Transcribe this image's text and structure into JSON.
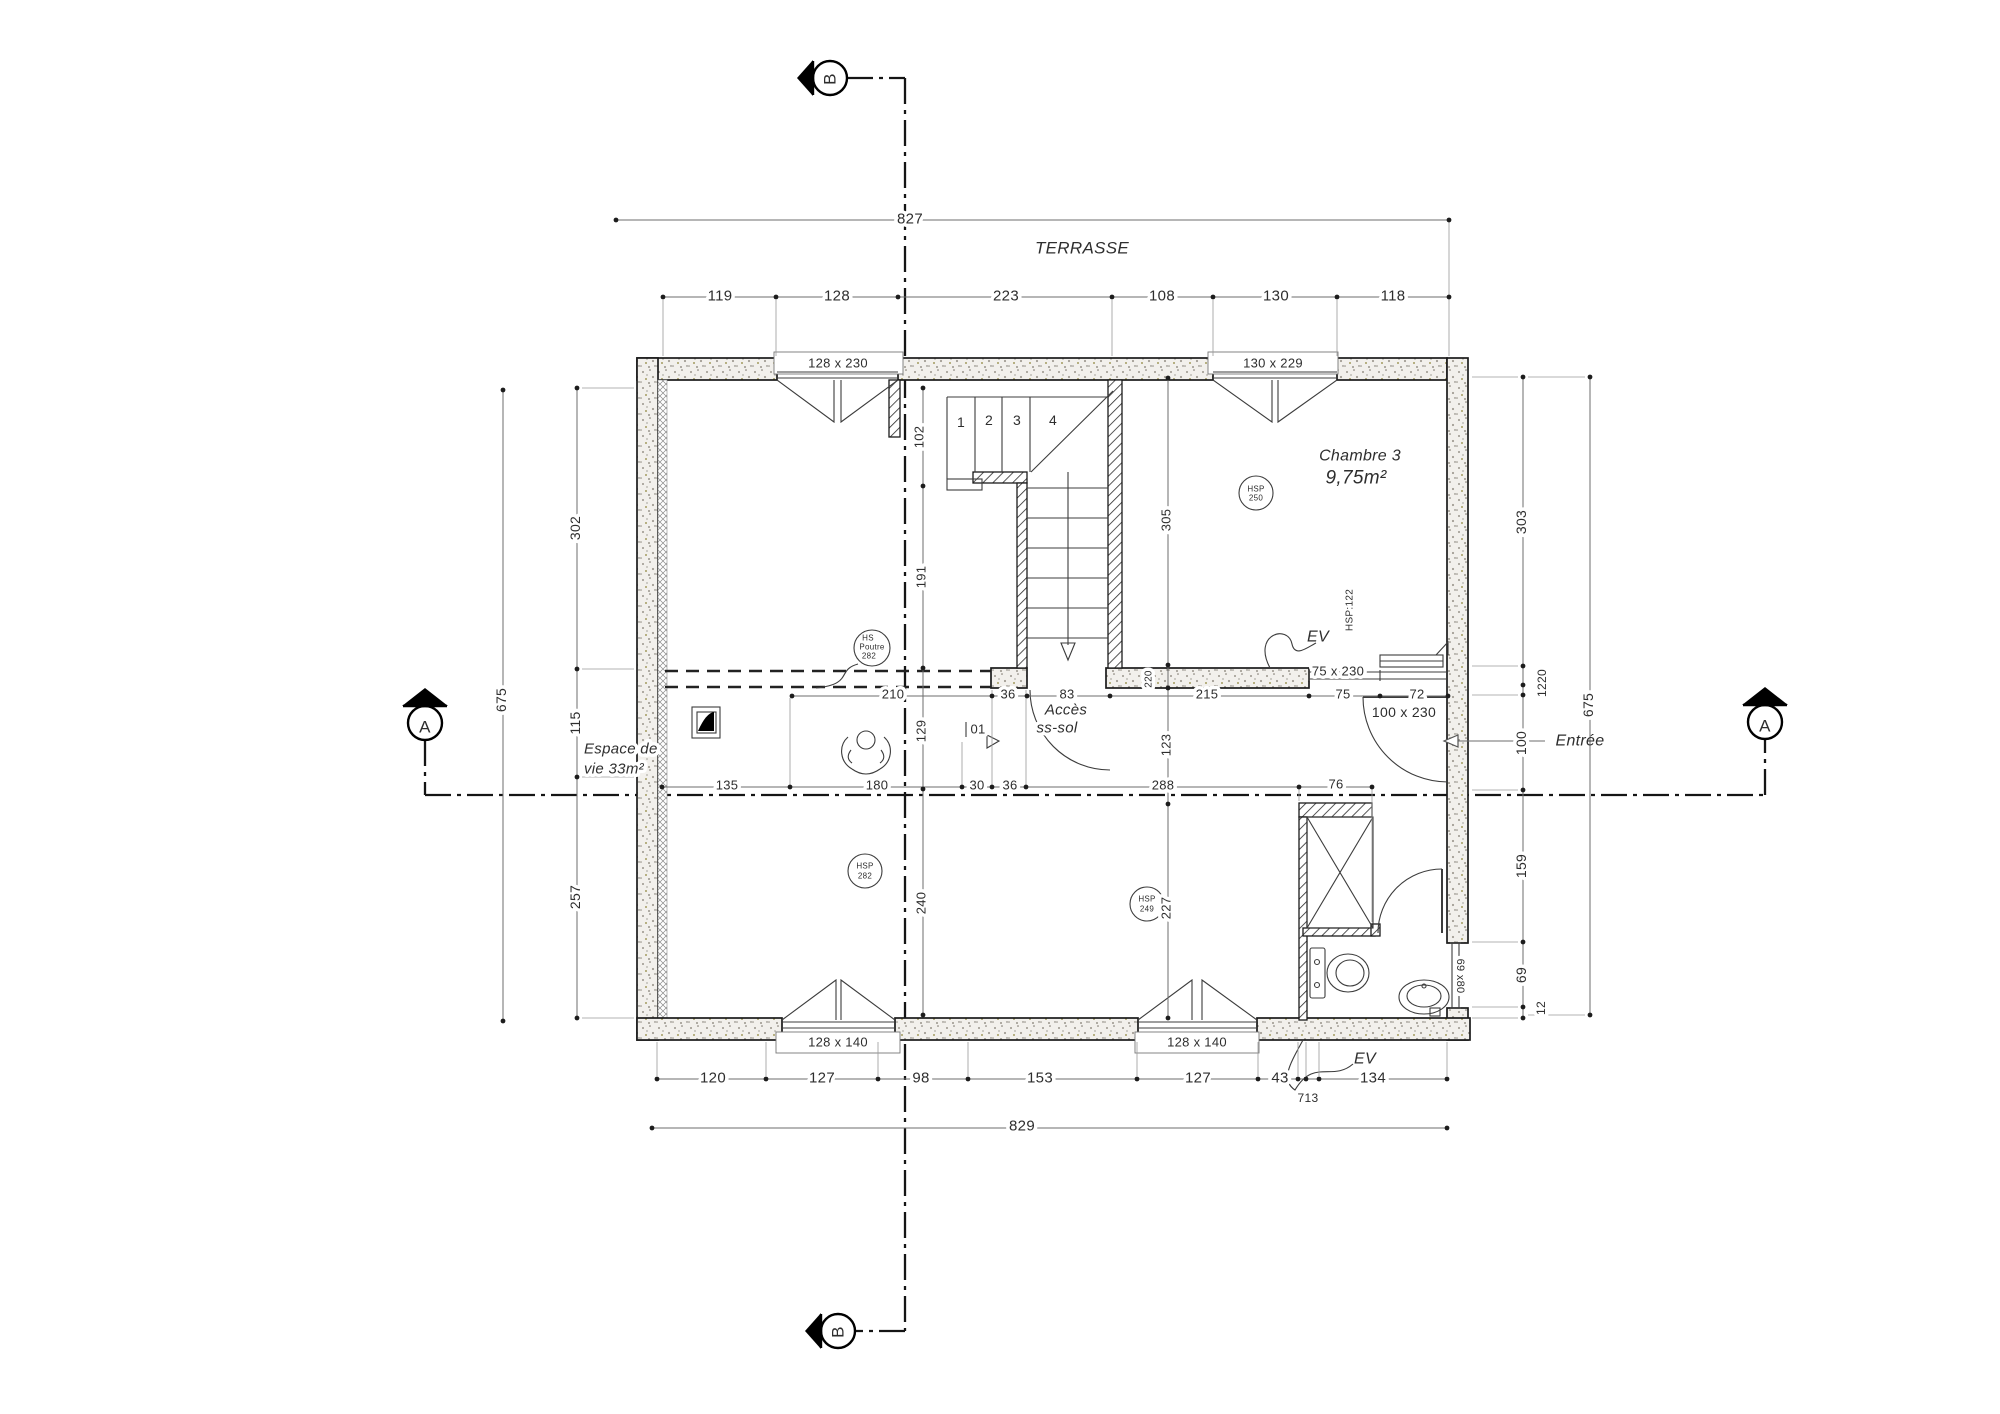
{
  "drawing": {
    "type": "architectural-floor-plan",
    "level_texts": [
      "TERRASSE",
      "Accès ss-sol",
      "Entrée"
    ],
    "rooms": [
      {
        "name": "Chambre 3",
        "area": "9,75m²",
        "ceiling_tag": "HSP 250"
      },
      {
        "name": "Espace de vie 33m²",
        "ceiling_tags": [
          "HS Poutre 282",
          "HSP 282",
          "HSP 249"
        ]
      }
    ],
    "section_markers": [
      "A",
      "A",
      "B",
      "B"
    ],
    "openings": [
      "128 x 230",
      "130 x 229",
      "75 x 230",
      "100 x 230",
      "128 x 140",
      "128 x 140",
      "69 x80"
    ],
    "dimension_strings": {
      "terrace_total": 827,
      "terrace_segments": [
        119,
        128,
        223,
        108,
        130,
        118
      ],
      "bottom_total": 829,
      "bottom_segments": [
        120,
        127,
        98,
        153,
        127,
        43,
        7,
        13,
        134
      ],
      "left_vertical": [
        302,
        115,
        257
      ],
      "left_total": 675,
      "right_vertical": [
        303,
        1220,
        100,
        159,
        69,
        12
      ],
      "right_total": 675,
      "interior_horizontal_upper": [
        210,
        36,
        83,
        215,
        75,
        72
      ],
      "interior_horizontal_lower": [
        135,
        180,
        30,
        36,
        288,
        76
      ],
      "interior_vertical_center": [
        102,
        191,
        129,
        240
      ],
      "interior_vertical_right": [
        305,
        123,
        227
      ],
      "wall_thickness": 220
    }
  },
  "labels": [
    {
      "name": "section-b-top-letter",
      "text": "B",
      "x": 830,
      "y": 79,
      "rot": -90,
      "size": 17
    },
    {
      "name": "dim-terrasse-total",
      "text": "827",
      "x": 910,
      "y": 219,
      "size": 15,
      "halo": true
    },
    {
      "name": "terrasse-title",
      "text": "TERRASSE",
      "x": 1082,
      "y": 248,
      "size": 17,
      "style": "italic"
    },
    {
      "name": "dim-terrasse-119",
      "text": "119",
      "x": 720,
      "y": 296,
      "size": 15,
      "halo": true
    },
    {
      "name": "dim-terrasse-128",
      "text": "128",
      "x": 837,
      "y": 296,
      "size": 15,
      "halo": true
    },
    {
      "name": "dim-terrasse-223",
      "text": "223",
      "x": 1006,
      "y": 296,
      "size": 15,
      "halo": true
    },
    {
      "name": "dim-terrasse-108",
      "text": "108",
      "x": 1162,
      "y": 296,
      "size": 15,
      "halo": true
    },
    {
      "name": "dim-terrasse-130",
      "text": "130",
      "x": 1276,
      "y": 296,
      "size": 15,
      "halo": true
    },
    {
      "name": "dim-terrasse-118",
      "text": "118",
      "x": 1393,
      "y": 296,
      "size": 15,
      "halo": true
    },
    {
      "name": "window-label-top-left",
      "text": "128 x 230",
      "x": 838,
      "y": 363,
      "size": 13
    },
    {
      "name": "window-label-top-right",
      "text": "130 x 229",
      "x": 1273,
      "y": 363,
      "size": 13
    },
    {
      "name": "stair-step-1",
      "text": "1",
      "x": 961,
      "y": 422,
      "size": 14
    },
    {
      "name": "stair-step-2",
      "text": "2",
      "x": 989,
      "y": 420,
      "size": 14
    },
    {
      "name": "stair-step-3",
      "text": "3",
      "x": 1017,
      "y": 420,
      "size": 14
    },
    {
      "name": "stair-step-4",
      "text": "4",
      "x": 1053,
      "y": 420,
      "size": 14
    },
    {
      "name": "dim-102",
      "text": "102",
      "x": 919,
      "y": 437,
      "rot": -90,
      "size": 13,
      "halo": true
    },
    {
      "name": "dim-191",
      "text": "191",
      "x": 921,
      "y": 577,
      "rot": -90,
      "size": 13,
      "halo": true
    },
    {
      "name": "dim-129",
      "text": "129",
      "x": 921,
      "y": 731,
      "rot": -90,
      "size": 13,
      "halo": true
    },
    {
      "name": "dim-240",
      "text": "240",
      "x": 921,
      "y": 903,
      "rot": -90,
      "size": 13,
      "halo": true
    },
    {
      "name": "dim-305",
      "text": "305",
      "x": 1166,
      "y": 520,
      "rot": -90,
      "size": 13,
      "halo": true
    },
    {
      "name": "dim-123",
      "text": "123",
      "x": 1166,
      "y": 745,
      "rot": -90,
      "size": 13,
      "halo": true
    },
    {
      "name": "dim-227",
      "text": "227",
      "x": 1166,
      "y": 908,
      "rot": -90,
      "size": 13,
      "halo": true
    },
    {
      "name": "dim-220",
      "text": "220",
      "x": 1149,
      "y": 679,
      "rot": -90,
      "size": 10,
      "halo": true
    },
    {
      "name": "room-chambre3-name",
      "text": "Chambre 3",
      "x": 1360,
      "y": 456,
      "size": 16,
      "style": "italic"
    },
    {
      "name": "room-chambre3-area",
      "text": "9,75m²",
      "x": 1356,
      "y": 478,
      "size": 19,
      "style": "italic"
    },
    {
      "name": "hsp250-line1",
      "text": "HSP",
      "x": 1256,
      "y": 489,
      "size": 8
    },
    {
      "name": "hsp250-line2",
      "text": "250",
      "x": 1256,
      "y": 498,
      "size": 8
    },
    {
      "name": "hsp122-note",
      "text": "HSP:122",
      "x": 1350,
      "y": 610,
      "rot": -90,
      "size": 10
    },
    {
      "name": "ev-chambre",
      "text": "EV",
      "x": 1318,
      "y": 637,
      "size": 16,
      "style": "italic"
    },
    {
      "name": "window-label-75x230",
      "text": "75 x 230",
      "x": 1338,
      "y": 671,
      "size": 13,
      "halo": true
    },
    {
      "name": "door-label-100x230",
      "text": "100 x 230",
      "x": 1404,
      "y": 712,
      "size": 14,
      "halo": true
    },
    {
      "name": "entree-label",
      "text": "Entrée",
      "x": 1580,
      "y": 741,
      "size": 16,
      "style": "italic"
    },
    {
      "name": "acces-line1",
      "text": "Accès",
      "x": 1066,
      "y": 710,
      "size": 15,
      "style": "italic",
      "halo": true
    },
    {
      "name": "acces-line2",
      "text": "ss-sol",
      "x": 1057,
      "y": 728,
      "size": 15,
      "style": "italic",
      "halo": true
    },
    {
      "name": "door-tag-01",
      "text": "01",
      "x": 978,
      "y": 729,
      "size": 13,
      "halo": true
    },
    {
      "name": "dim-210",
      "text": "210",
      "x": 893,
      "y": 694,
      "size": 13,
      "halo": true
    },
    {
      "name": "dim-36-upper",
      "text": "36",
      "x": 1008,
      "y": 694,
      "size": 13,
      "halo": true
    },
    {
      "name": "dim-83",
      "text": "83",
      "x": 1067,
      "y": 694,
      "size": 13,
      "halo": true
    },
    {
      "name": "dim-215",
      "text": "215",
      "x": 1207,
      "y": 694,
      "size": 13,
      "halo": true
    },
    {
      "name": "dim-75",
      "text": "75",
      "x": 1343,
      "y": 694,
      "size": 13,
      "halo": true
    },
    {
      "name": "dim-72",
      "text": "72",
      "x": 1417,
      "y": 694,
      "size": 13,
      "halo": true
    },
    {
      "name": "dim-135",
      "text": "135",
      "x": 727,
      "y": 785,
      "size": 13,
      "halo": true
    },
    {
      "name": "dim-180",
      "text": "180",
      "x": 877,
      "y": 785,
      "size": 13,
      "halo": true
    },
    {
      "name": "dim-30",
      "text": "30",
      "x": 977,
      "y": 785,
      "size": 13,
      "halo": true
    },
    {
      "name": "dim-36-lower",
      "text": "36",
      "x": 1010,
      "y": 785,
      "size": 13,
      "halo": true
    },
    {
      "name": "dim-288",
      "text": "288",
      "x": 1163,
      "y": 785,
      "size": 13,
      "halo": true
    },
    {
      "name": "dim-76",
      "text": "76",
      "x": 1336,
      "y": 784,
      "size": 13,
      "halo": true
    },
    {
      "name": "hs-poutre-line1",
      "text": "HS",
      "x": 868,
      "y": 638,
      "size": 8
    },
    {
      "name": "hs-poutre-line2",
      "text": "Poutre",
      "x": 872,
      "y": 647,
      "size": 8
    },
    {
      "name": "hs-poutre-line3",
      "text": "282",
      "x": 869,
      "y": 656,
      "size": 8
    },
    {
      "name": "hsp282-line1",
      "text": "HSP",
      "x": 865,
      "y": 866,
      "size": 8
    },
    {
      "name": "hsp282-line2",
      "text": "282",
      "x": 865,
      "y": 876,
      "size": 8
    },
    {
      "name": "hsp249-line1",
      "text": "HSP",
      "x": 1147,
      "y": 899,
      "size": 8
    },
    {
      "name": "hsp249-line2",
      "text": "249",
      "x": 1147,
      "y": 909,
      "size": 8
    },
    {
      "name": "espace-de-vie-line1",
      "text": "Espace de",
      "x": 584,
      "y": 749,
      "size": 15,
      "style": "italic",
      "anchor": "start",
      "halo": true
    },
    {
      "name": "espace-de-vie-line2",
      "text": "vie 33m²",
      "x": 584,
      "y": 769,
      "size": 15,
      "style": "italic",
      "anchor": "start",
      "halo": true
    },
    {
      "name": "dim-302",
      "text": "302",
      "x": 575,
      "y": 528,
      "rot": -90,
      "size": 14,
      "halo": true
    },
    {
      "name": "dim-115",
      "text": "115",
      "x": 575,
      "y": 723,
      "rot": -90,
      "size": 14,
      "halo": true
    },
    {
      "name": "dim-257",
      "text": "257",
      "x": 575,
      "y": 897,
      "rot": -90,
      "size": 14,
      "halo": true
    },
    {
      "name": "dim-675-left",
      "text": "675",
      "x": 501,
      "y": 700,
      "rot": -90,
      "size": 14,
      "halo": true
    },
    {
      "name": "dim-303",
      "text": "303",
      "x": 1521,
      "y": 522,
      "rot": -90,
      "size": 14,
      "halo": true
    },
    {
      "name": "dim-1220",
      "text": "1220",
      "x": 1542,
      "y": 683,
      "rot": -90,
      "size": 12,
      "halo": true
    },
    {
      "name": "dim-100",
      "text": "100",
      "x": 1521,
      "y": 743,
      "rot": -90,
      "size": 14,
      "halo": true
    },
    {
      "name": "dim-159",
      "text": "159",
      "x": 1521,
      "y": 866,
      "rot": -90,
      "size": 14,
      "halo": true
    },
    {
      "name": "dim-69",
      "text": "69",
      "x": 1521,
      "y": 975,
      "rot": -90,
      "size": 14,
      "halo": true
    },
    {
      "name": "dim-12",
      "text": "12",
      "x": 1541,
      "y": 1008,
      "rot": -90,
      "size": 12,
      "halo": true
    },
    {
      "name": "dim-675-right",
      "text": "675",
      "x": 1588,
      "y": 705,
      "rot": -90,
      "size": 14,
      "halo": true
    },
    {
      "name": "window-label-69x80",
      "text": "69 x80",
      "x": 1460,
      "y": 976,
      "rot": 90,
      "size": 11,
      "halo": true
    },
    {
      "name": "window-label-bottom-left",
      "text": "128 x 140",
      "x": 838,
      "y": 1042,
      "size": 13
    },
    {
      "name": "window-label-bottom-right",
      "text": "128 x 140",
      "x": 1197,
      "y": 1042,
      "size": 13
    },
    {
      "name": "ev-bottom",
      "text": "EV",
      "x": 1365,
      "y": 1059,
      "size": 16,
      "style": "italic"
    },
    {
      "name": "dim-120",
      "text": "120",
      "x": 713,
      "y": 1078,
      "size": 15,
      "halo": true
    },
    {
      "name": "dim-127-a",
      "text": "127",
      "x": 822,
      "y": 1078,
      "size": 15,
      "halo": true
    },
    {
      "name": "dim-98",
      "text": "98",
      "x": 921,
      "y": 1078,
      "size": 15,
      "halo": true
    },
    {
      "name": "dim-153",
      "text": "153",
      "x": 1040,
      "y": 1078,
      "size": 15,
      "halo": true
    },
    {
      "name": "dim-127-b",
      "text": "127",
      "x": 1198,
      "y": 1078,
      "size": 15,
      "halo": true
    },
    {
      "name": "dim-43",
      "text": "43",
      "x": 1280,
      "y": 1078,
      "size": 15,
      "halo": true
    },
    {
      "name": "dim-134",
      "text": "134",
      "x": 1373,
      "y": 1078,
      "size": 15,
      "halo": true
    },
    {
      "name": "dim-713",
      "text": "713",
      "x": 1308,
      "y": 1098,
      "size": 12,
      "halo": true
    },
    {
      "name": "dim-829",
      "text": "829",
      "x": 1022,
      "y": 1126,
      "size": 15,
      "halo": true
    },
    {
      "name": "section-b-bottom-letter",
      "text": "B",
      "x": 838,
      "y": 1332,
      "rot": -90,
      "size": 17
    },
    {
      "name": "section-a-left-letter",
      "text": "A",
      "x": 425,
      "y": 727,
      "size": 17
    },
    {
      "name": "section-a-right-letter",
      "text": "A",
      "x": 1765,
      "y": 726,
      "size": 17
    }
  ]
}
